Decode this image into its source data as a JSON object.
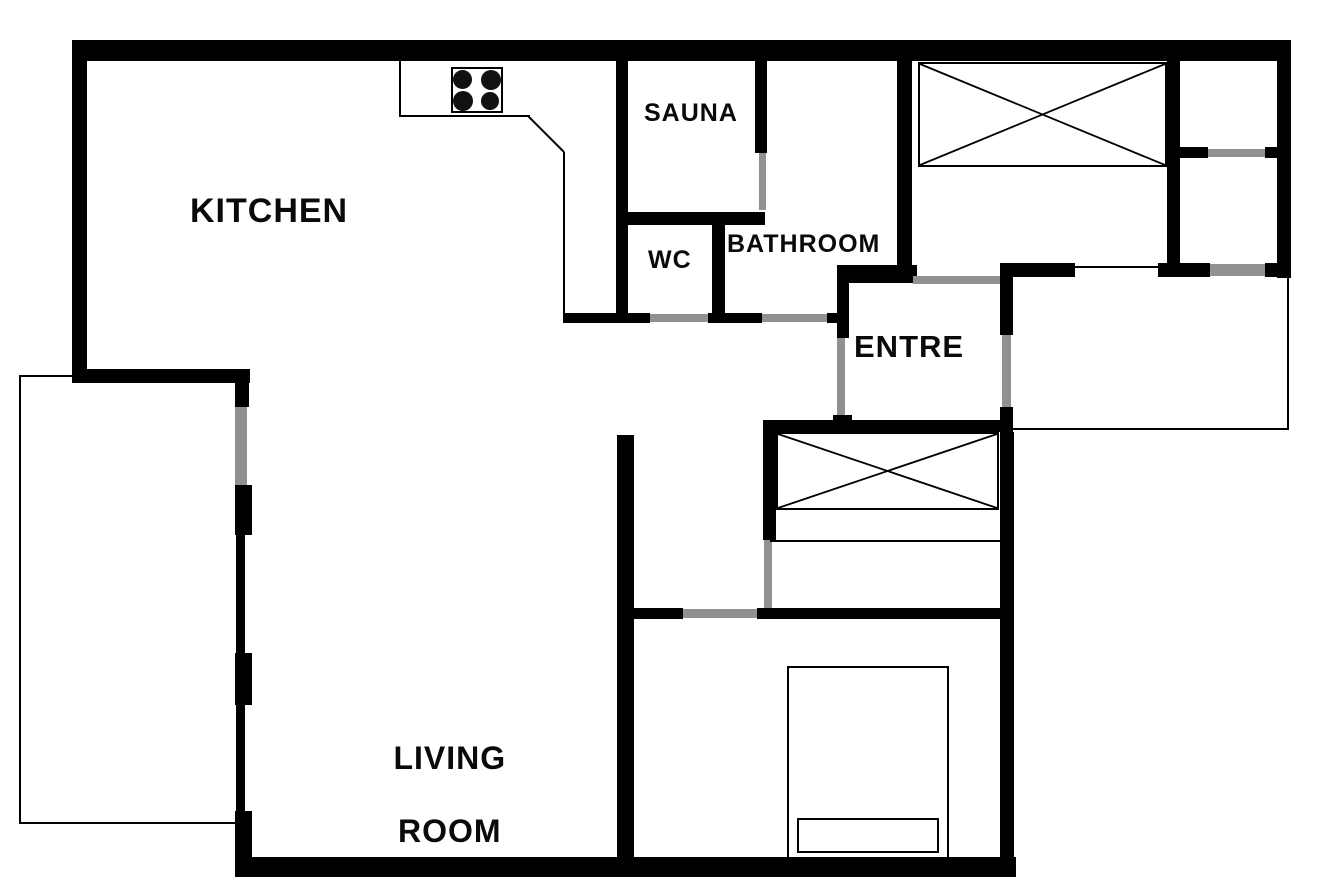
{
  "colors": {
    "wall": "#000000",
    "door_opening": "#919191",
    "background": "#ffffff"
  },
  "rooms": {
    "kitchen": {
      "label": "KITCHEN"
    },
    "sauna": {
      "label": "SAUNA"
    },
    "wc": {
      "label": "WC"
    },
    "bathroom": {
      "label": "BATHROOM"
    },
    "entre": {
      "label": "ENTRE"
    },
    "living_room": {
      "line1": "LIVING",
      "line2": "ROOM"
    }
  },
  "furniture": {
    "stove": "stove-4-burners",
    "wardrobe_top_right": "crossed-wardrobe",
    "wardrobe_hall": "crossed-wardrobe",
    "bed": "double-bed",
    "counter": "kitchen-counter"
  }
}
